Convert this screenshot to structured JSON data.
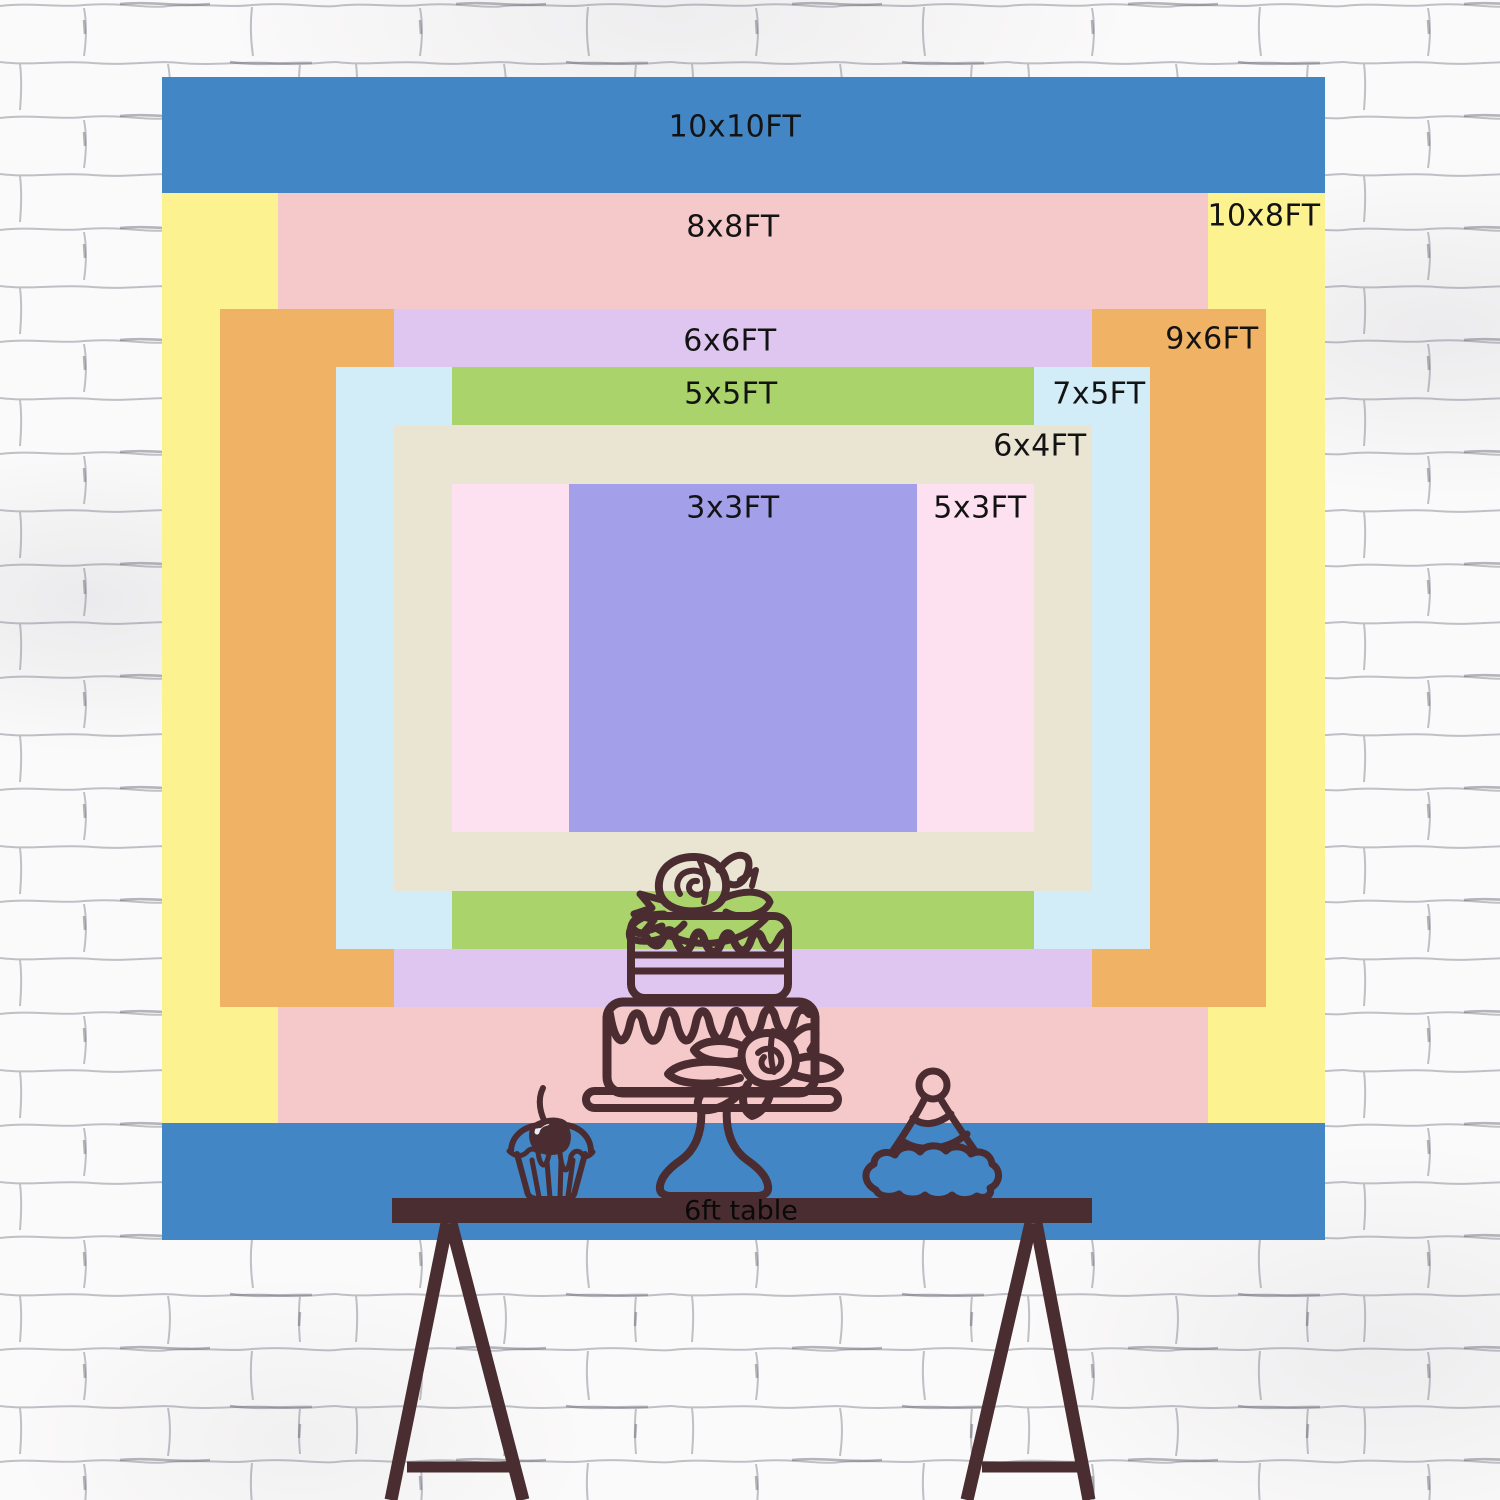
{
  "backdrop": {
    "description": "nested backdrop size comparison chart",
    "unit": "FT",
    "label_text_color": "#131313",
    "sizes": [
      {
        "label": "10x10FT",
        "width_ft": 10,
        "height_ft": 10,
        "color": "#4286c6",
        "label_x": 735,
        "label_y": 127
      },
      {
        "label": "10x8FT",
        "width_ft": 10,
        "height_ft": 8,
        "color": "#fcf290",
        "label_x": 1264,
        "label_y": 216
      },
      {
        "label": "8x8FT",
        "width_ft": 8,
        "height_ft": 8,
        "color": "#f5c9ca",
        "label_x": 733,
        "label_y": 227
      },
      {
        "label": "9x6FT",
        "width_ft": 9,
        "height_ft": 6,
        "color": "#f0b264",
        "label_x": 1212,
        "label_y": 339
      },
      {
        "label": "6x6FT",
        "width_ft": 6,
        "height_ft": 6,
        "color": "#dec6f0",
        "label_x": 730,
        "label_y": 341
      },
      {
        "label": "7x5FT",
        "width_ft": 7,
        "height_ft": 5,
        "color": "#d2edf8",
        "label_x": 1099,
        "label_y": 394
      },
      {
        "label": "5x5FT",
        "width_ft": 5,
        "height_ft": 5,
        "color": "#aad46b",
        "label_x": 731,
        "label_y": 394
      },
      {
        "label": "6x4FT",
        "width_ft": 6,
        "height_ft": 4,
        "color": "#eae4d3",
        "label_x": 1040,
        "label_y": 446
      },
      {
        "label": "5x3FT",
        "width_ft": 5,
        "height_ft": 3,
        "color": "#fde1f0",
        "label_x": 980,
        "label_y": 508
      },
      {
        "label": "3x3FT",
        "width_ft": 3,
        "height_ft": 3,
        "color": "#a3a0e9",
        "label_x": 733,
        "label_y": 508
      }
    ]
  },
  "table": {
    "label": "6ft table",
    "length_ft": 6,
    "color": "#4a2d30"
  },
  "illustrations": {
    "stroke_color": "#4a2c31",
    "items": [
      "tiered-cake",
      "cupcake",
      "party-hat",
      "trestle-table"
    ]
  },
  "wall": {
    "background": "#fbfafa",
    "mortar_line": "#9b9ba6",
    "accent_line": "#6e6e7a"
  }
}
